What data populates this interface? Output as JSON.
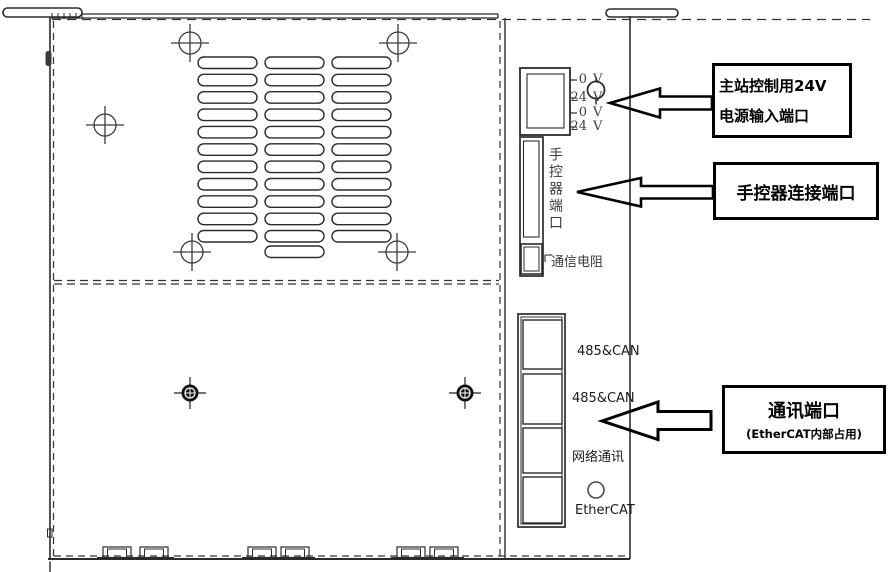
{
  "device": {
    "power_terminals": [
      {
        "value": "0",
        "unit": "V"
      },
      {
        "value": "24",
        "unit": "V"
      },
      {
        "value": "0",
        "unit": "V"
      },
      {
        "value": "24",
        "unit": "V"
      }
    ],
    "hand_port_label": "手控器端口",
    "resistor_label": "通信电阻",
    "comm_port_labels": [
      "485&CAN",
      "485&CAN",
      "网络通讯",
      "EtherCAT"
    ]
  },
  "callouts": {
    "power": {
      "line1": "主站控制用24V",
      "line2": "电源输入端口"
    },
    "hand_controller": {
      "label": "手控器连接端口"
    },
    "comm": {
      "title": "通讯端口",
      "subtitle": "(EtherCAT内部占用)"
    }
  }
}
